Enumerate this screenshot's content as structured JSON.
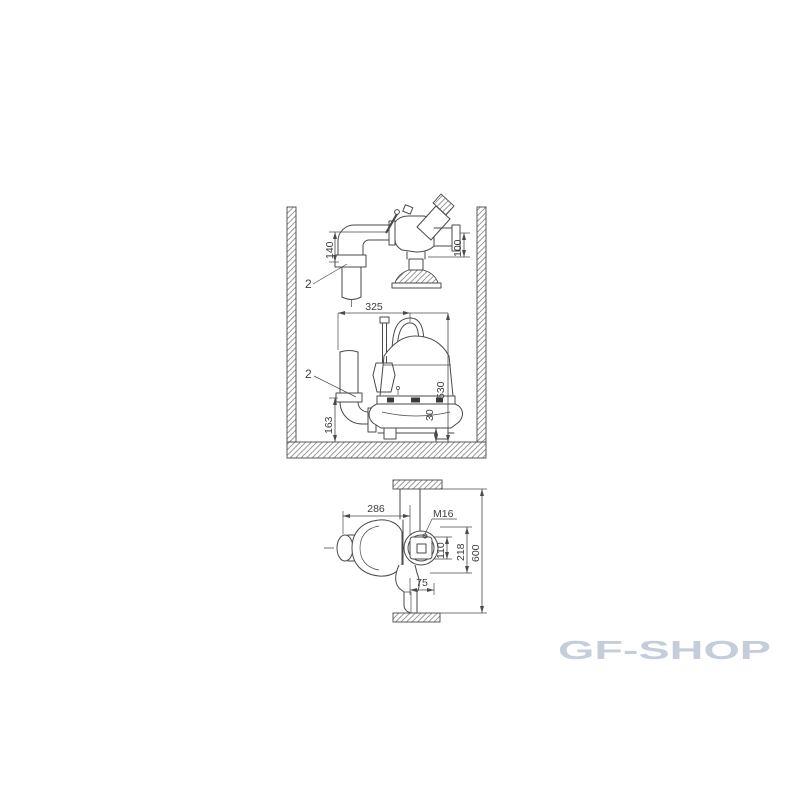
{
  "background_color": "#ffffff",
  "watermark": {
    "text": "GF-SHOP",
    "color": "#c4cedb"
  },
  "drawing": {
    "stroke_color": "#4a4a4a",
    "hatch_color": "#8f8f8f",
    "label_color": "#3d3d3d",
    "top_figure": {
      "labels": {
        "d140": "140",
        "d100": "100",
        "callout": "2"
      }
    },
    "middle_figure": {
      "labels": {
        "d325": "325",
        "d530": "530",
        "d163": "163",
        "d30": "30",
        "callout": "2"
      }
    },
    "bottom_figure": {
      "labels": {
        "d286": "286",
        "m16": "M16",
        "d110": "110",
        "d218": "218",
        "d600": "600",
        "d75": "75"
      }
    }
  }
}
